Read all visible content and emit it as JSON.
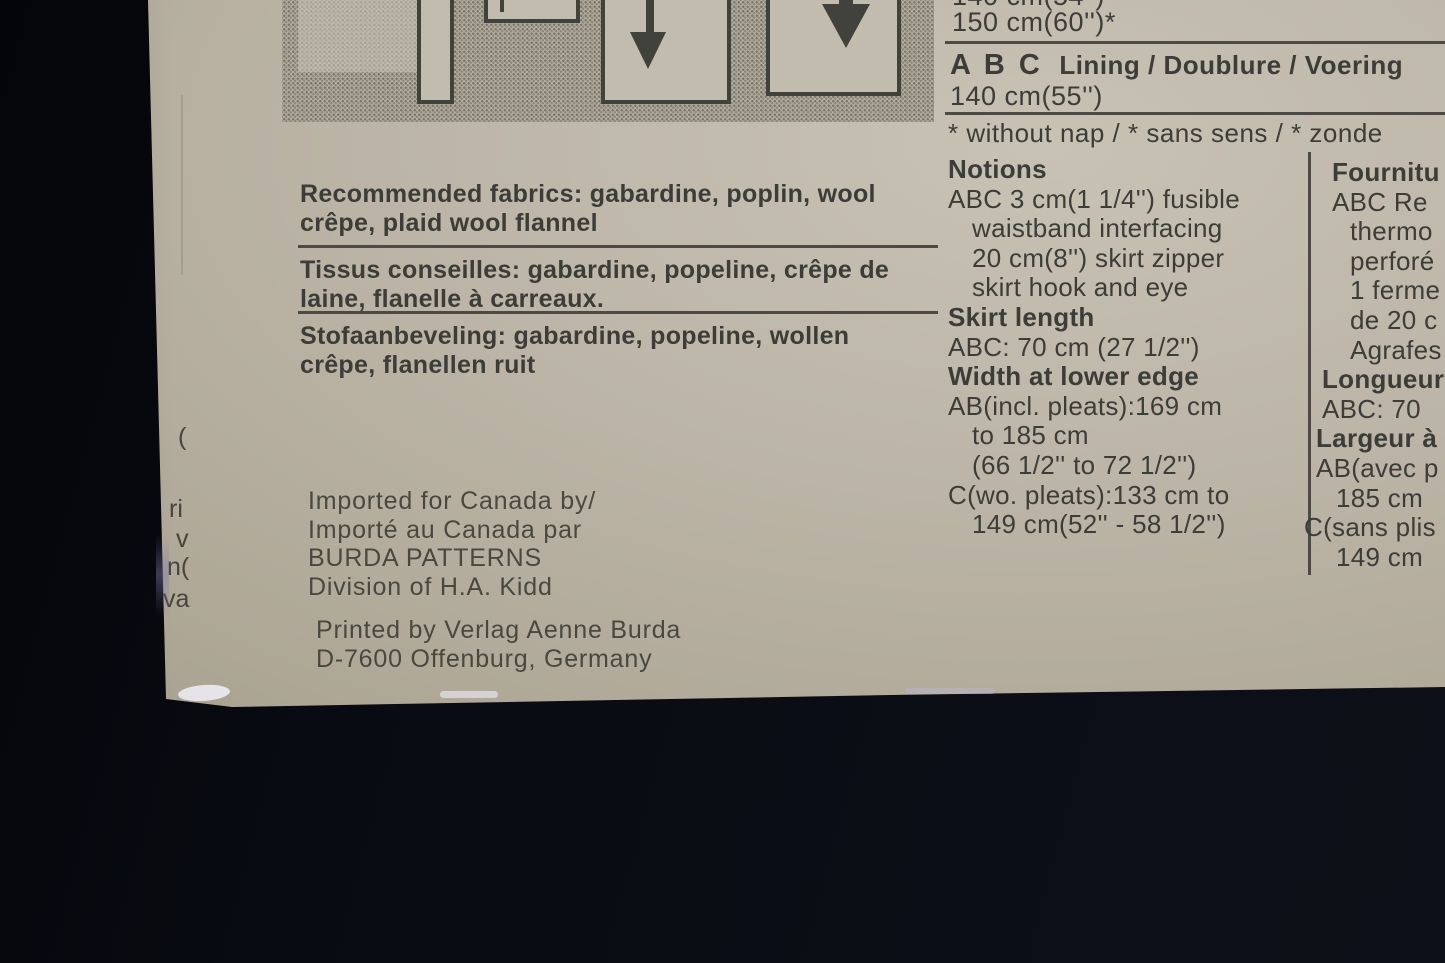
{
  "photo": {
    "backdrop_color": "#0a0c13",
    "paper_color": "#b7b0a2",
    "ink_color": "#3c3c38"
  },
  "yardage": {
    "clipped_line": "140 cm(54'')",
    "width_150": "150 cm(60'')*",
    "lining_sizes": "A B C",
    "lining_label": "Lining / Doublure / Voering",
    "lining_width": "140 cm(55'')",
    "footnote": "* without nap / * sans sens / * zonde"
  },
  "fabrics": {
    "en_line1": "Recommended fabrics: gabardine, poplin, wool",
    "en_line2": "crêpe, plaid wool flannel",
    "fr_line1": "Tissus conseilles: gabardine, popeline, crêpe de",
    "fr_line2": "laine, flanelle à carreaux.",
    "nl_line1": "Stofaanbeveling: gabardine, popeline, wollen",
    "nl_line2": "crêpe, flanellen ruit"
  },
  "notions": {
    "lines": [
      {
        "t": "Notions"
      },
      {
        "t": "ABC 3 cm(1 1/4'') fusible"
      },
      {
        "t": "waistband interfacing"
      },
      {
        "t": "20 cm(8'') skirt zipper"
      },
      {
        "t": "skirt hook and eye"
      },
      {
        "t": "Skirt length"
      },
      {
        "t": "ABC: 70 cm (27 1/2'')"
      },
      {
        "t": "Width at lower edge"
      },
      {
        "t": "AB(incl. pleats):169 cm"
      },
      {
        "t": "to 185 cm"
      },
      {
        "t": "(66 1/2'' to 72 1/2'')"
      },
      {
        "t": "C(wo. pleats):133 cm to"
      },
      {
        "t": "149 cm(52'' - 58 1/2'')"
      }
    ]
  },
  "fournitures": {
    "lines": [
      {
        "t": "Fournitu"
      },
      {
        "t": "ABC Re"
      },
      {
        "t": "thermo"
      },
      {
        "t": "perforé"
      },
      {
        "t": "1 ferme"
      },
      {
        "t": "de 20 c"
      },
      {
        "t": "Agrafes"
      },
      {
        "t": "Longueur"
      },
      {
        "t": "ABC: 70"
      },
      {
        "t": "Largeur à"
      },
      {
        "t": "AB(avec p"
      },
      {
        "t": "185 cm"
      },
      {
        "t": "C(sans plis"
      },
      {
        "t": "149 cm"
      }
    ]
  },
  "imprint": {
    "line1": "Imported for Canada by/",
    "line2": "Importé au Canada par",
    "line3": "BURDA PATTERNS",
    "line4": "Division of H.A. Kidd",
    "line5": "Printed by Verlag Aenne Burda",
    "line6": "D-7600 Offenburg, Germany"
  },
  "edge_fragments": [
    "(",
    "ri",
    "v",
    "n(",
    "va"
  ],
  "diagram_pieces": [
    "waistband-strip",
    "small-facing-piece",
    "skirt-panel-grainline-arrow",
    "skirt-panel-wide-grainline-arrow"
  ]
}
